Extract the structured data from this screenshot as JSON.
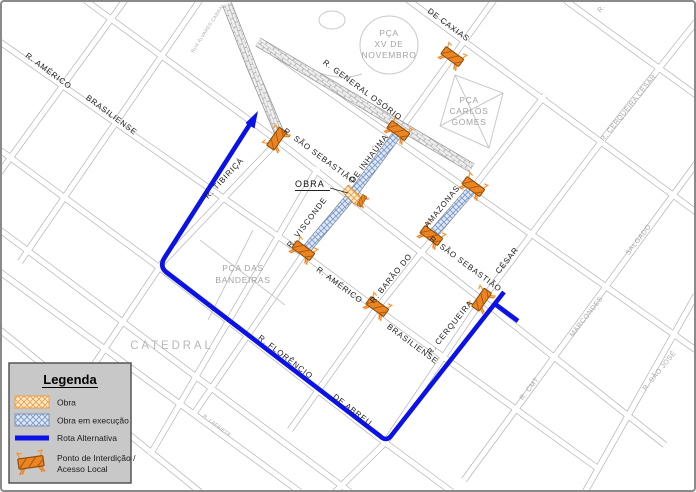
{
  "legend": {
    "title": "Legenda",
    "items": [
      {
        "label": "Obra",
        "swatch": "orange-hatch"
      },
      {
        "label": "Obra em execução",
        "swatch": "blue-hatch"
      },
      {
        "label": "Rota Alternativa",
        "swatch": "blue-line"
      },
      {
        "label": "Ponto de Interdição /",
        "label_line2": "Acesso Local",
        "swatch": "barricade-icon"
      }
    ]
  },
  "map": {
    "callout_obra": "OBRA",
    "plazas": {
      "pca_xv": [
        "PÇA",
        "XV DE",
        "NOVEMBRO"
      ],
      "pca_carlos_gomes": [
        "PÇA",
        "CARLOS",
        "GOMES"
      ],
      "pca_das_bandeiras": [
        "PÇA DAS",
        "BANDEIRAS"
      ],
      "catedral": "CATEDRAL"
    },
    "street_labels": {
      "r_americo_nw": "R. AMÉRICO",
      "brasiliense_nw": "BRASILIENSE",
      "r_tibirica": "R. TIBIRIÇÁ",
      "r_sao_sebastiao_w": "R. SÃO SEBASTIÃO",
      "r_general_osorio": "R. GENERAL OSÓRIO",
      "de_caxias": "DE CAXIAS",
      "rua_alvares_cabral": "RUA ÁLVARES CABRAL",
      "de_inhauma": "DE INHAÚMA",
      "r_visconde": "R. VISCONDE",
      "amazonas": "AMAZONAS",
      "r_barao_do": "R. BARÃO DO",
      "r_americo_c": "R. AMÉRICO",
      "brasiliense_c": "BRASILIENSE",
      "r_sao_sebastiao_e": "R. SÃO SEBASTIÃO",
      "cesar": "CÉSAR",
      "r_cerqueira": "R. CERQUEIRA",
      "r_cerqueira_cesar": "R. CERQUEIRA CÉSAR",
      "r_florencio": "R. FLORÊNCIO",
      "de_abreu": "DE ABREU",
      "salgado": "SALGADO",
      "marcondes": "MARCONDES",
      "r_cmt": "R. CMT",
      "r_sao_jose": "R. SÃO JOSÉ",
      "r_lafaiete": "R. LAFAIETE",
      "r_fragment": "R."
    }
  },
  "colors": {
    "route_blue": "#0A12E8",
    "barricade_orange": "#ED8422",
    "obra_hatch_orange": "#F0A24E",
    "execucao_hatch_blue": "#7B97C9",
    "street_gray": "#B3B3B3",
    "legend_bg": "#C8C8C8"
  }
}
